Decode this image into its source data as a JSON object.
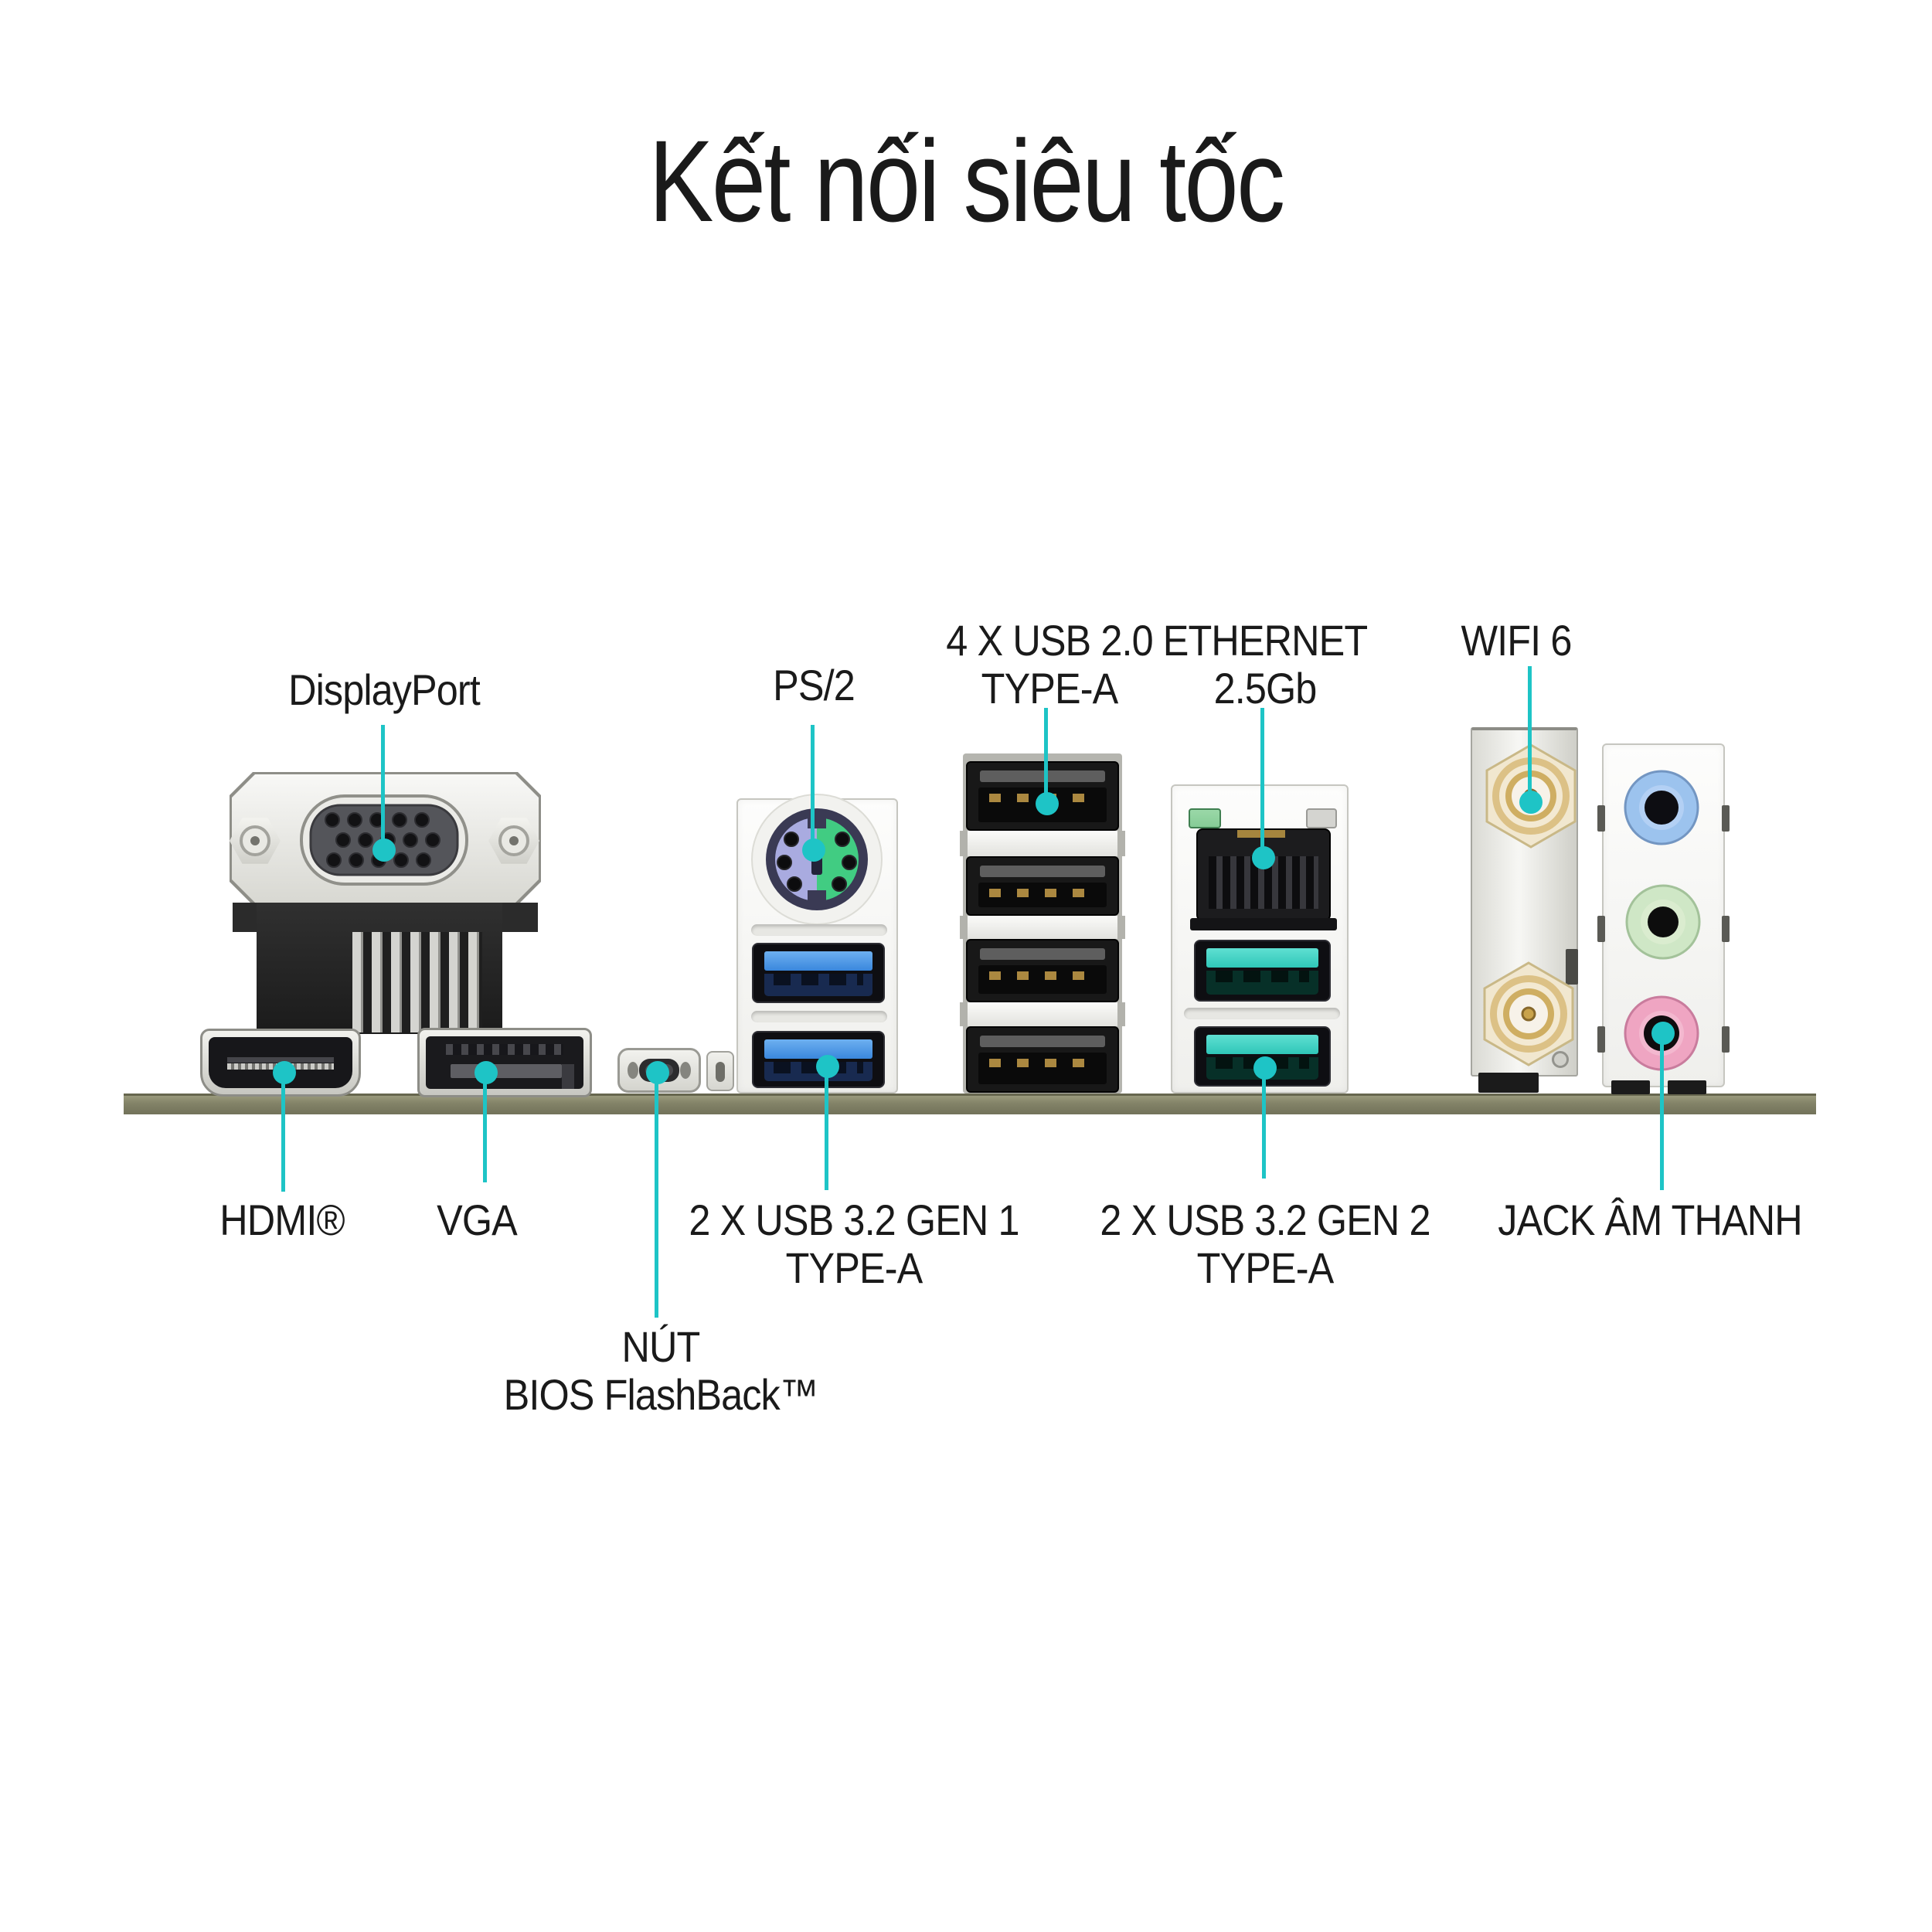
{
  "title": "Kết nối siêu tốc",
  "callouts": {
    "displayport": {
      "label": "DisplayPort"
    },
    "ps2": {
      "label": "PS/2"
    },
    "usb2": {
      "line1": "4 X USB 2.0",
      "line2": "TYPE-A"
    },
    "ethernet": {
      "line1": "ETHERNET",
      "line2": "2.5Gb"
    },
    "wifi": {
      "label": "WIFI 6"
    },
    "hdmi": {
      "label": "HDMI®"
    },
    "vga": {
      "label": "VGA"
    },
    "bios_flashback": {
      "line1": "NÚT",
      "line2": "BIOS FlashBack™"
    },
    "usb32_gen1": {
      "line1": "2 X USB 3.2 GEN 1",
      "line2": "TYPE-A"
    },
    "usb32_gen2": {
      "line1": "2 X USB 3.2 GEN 2",
      "line2": "TYPE-A"
    },
    "audio": {
      "label": "JACK ÂM THANH"
    }
  },
  "colors": {
    "accent": "#1ec4c6",
    "text": "#1a1a1a",
    "pcb": "#83836a",
    "ps2_purple": "#a9abe0",
    "ps2_green": "#41cc82",
    "usb3_gen1_blue": "#3a87dd",
    "usb3_gen2_teal": "#2fc7b8",
    "usb2_black": "#181818",
    "ethernet_led_green": "#86cc96",
    "audio_line_in_blue": "#9cc3ee",
    "audio_line_out_green": "#cfe7c6",
    "audio_mic_pink": "#efa5c2",
    "sma_gold": "#cfae62"
  }
}
